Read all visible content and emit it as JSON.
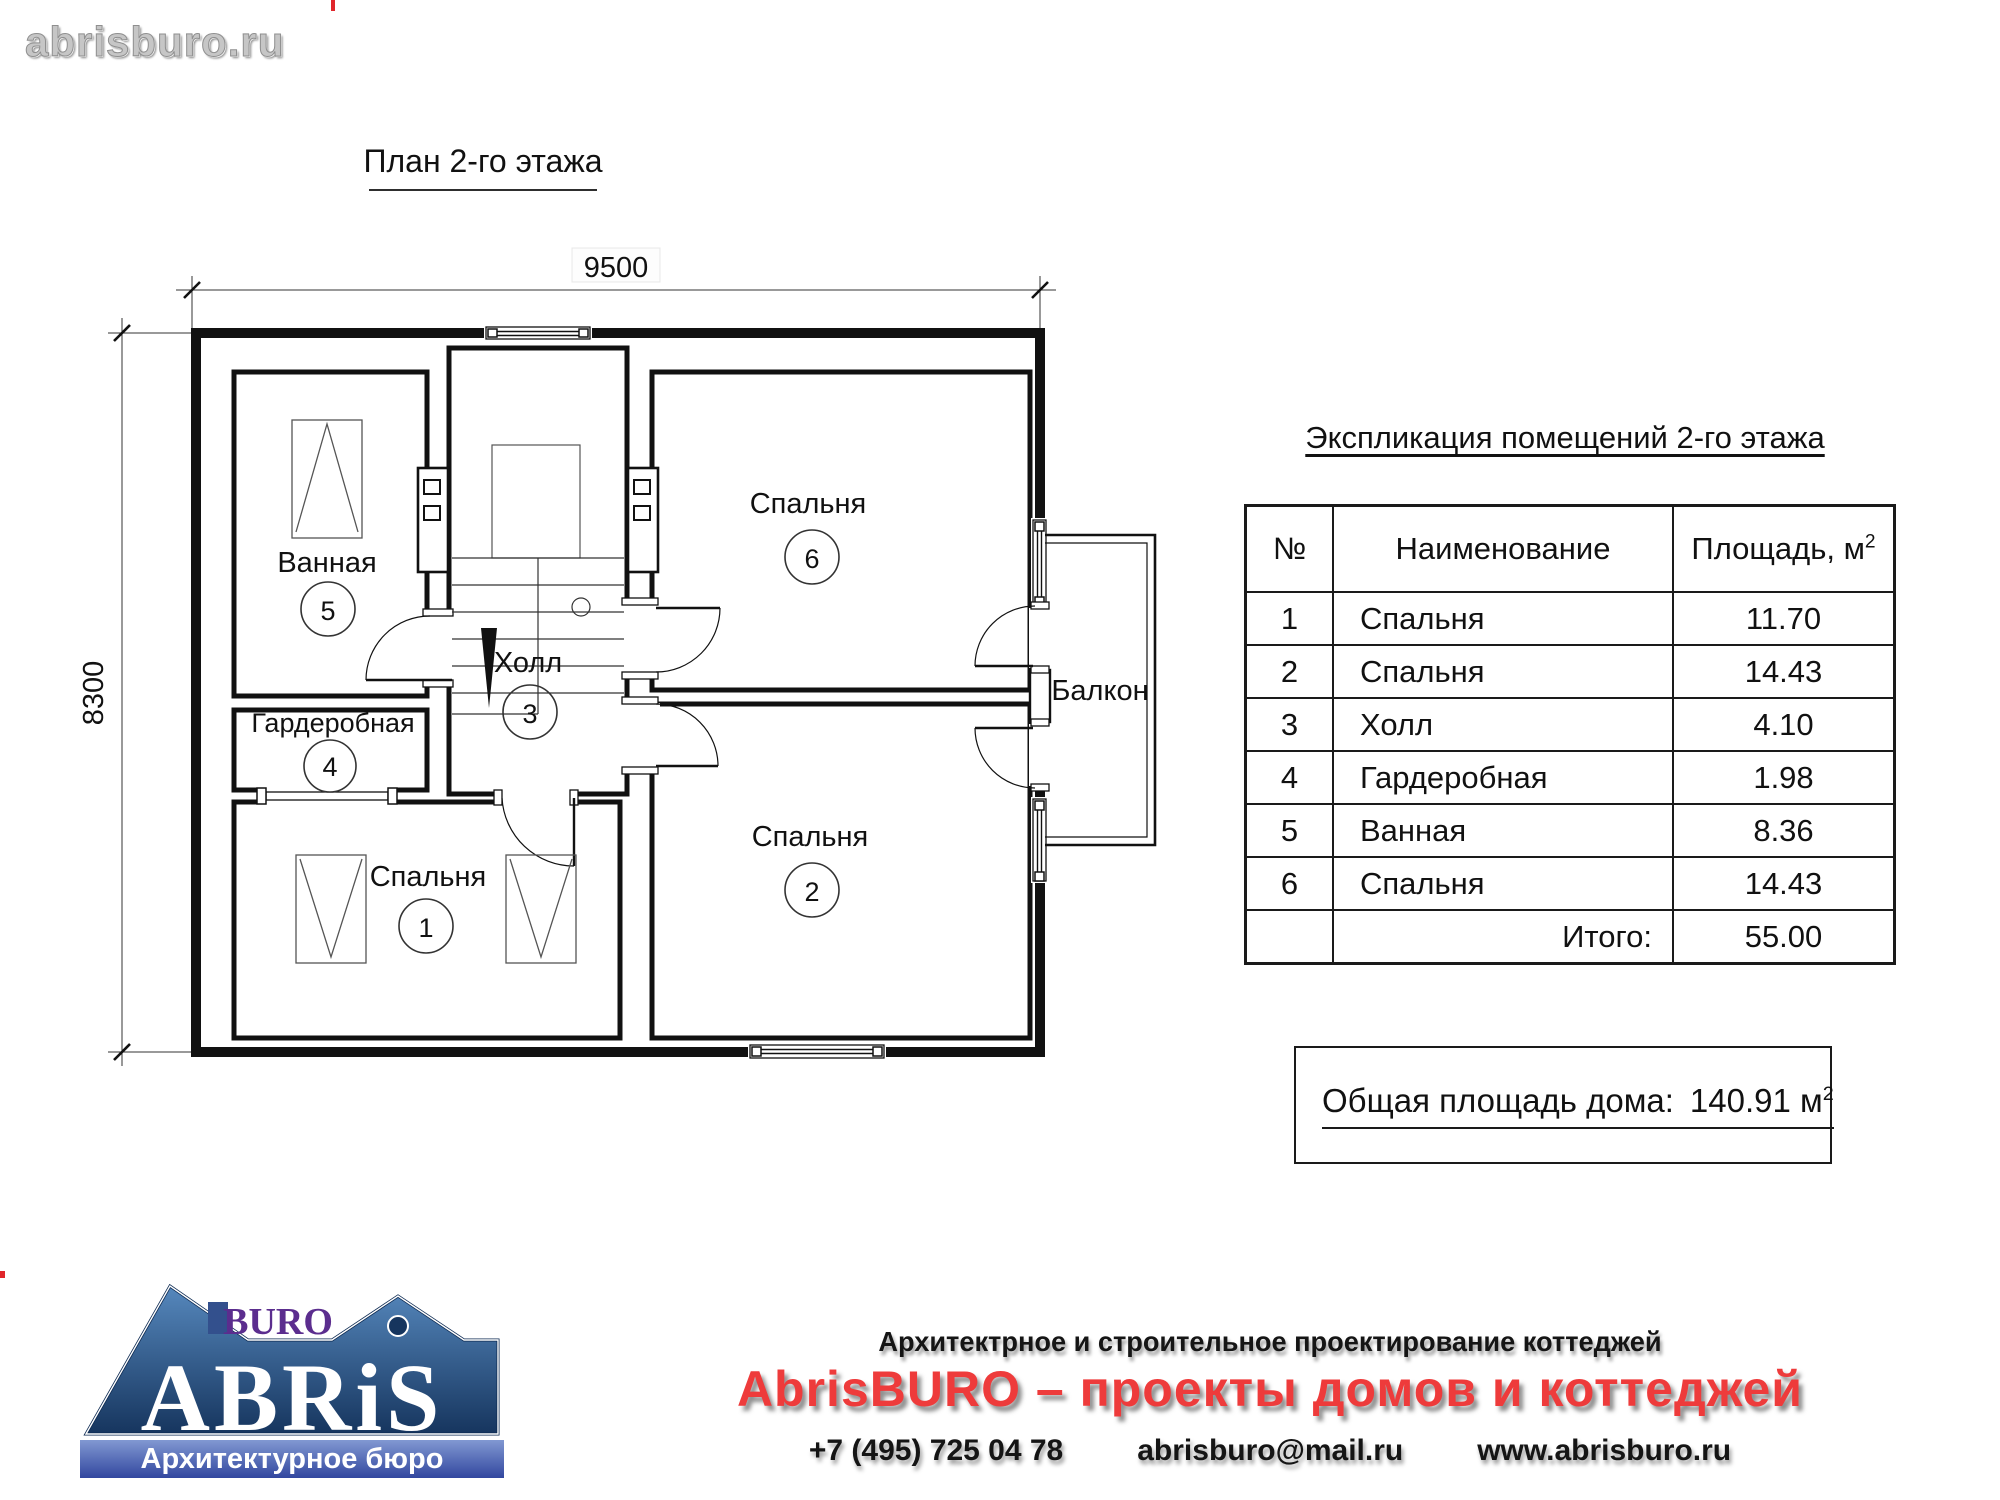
{
  "watermark": "abrisburo.ru",
  "plan": {
    "title": "План 2-го этажа",
    "dim_width": "9500",
    "dim_height": "8300",
    "rooms": [
      {
        "num": "1",
        "label": "Спальня"
      },
      {
        "num": "2",
        "label": "Спальня"
      },
      {
        "num": "3",
        "label": "Холл"
      },
      {
        "num": "4",
        "label": "Гардеробная"
      },
      {
        "num": "5",
        "label": "Ванная"
      },
      {
        "num": "6",
        "label": "Спальня"
      }
    ],
    "balcony_label": "Балкон"
  },
  "legend": {
    "title": "Экспликация помещений 2-го этажа",
    "columns": {
      "num": "№",
      "name": "Наименование",
      "area": "Площадь, м",
      "area_sup": "2"
    },
    "rows": [
      {
        "num": "1",
        "name": "Спальня",
        "area": "11.70"
      },
      {
        "num": "2",
        "name": "Спальня",
        "area": "14.43"
      },
      {
        "num": "3",
        "name": "Холл",
        "area": "4.10"
      },
      {
        "num": "4",
        "name": "Гардеробная",
        "area": "1.98"
      },
      {
        "num": "5",
        "name": "Ванная",
        "area": "8.36"
      },
      {
        "num": "6",
        "name": "Спальня",
        "area": "14.43"
      }
    ],
    "total_label": "Итого:",
    "total_value": "55.00"
  },
  "summary": {
    "label": "Общая площадь дома:",
    "value": "140.91",
    "unit": "м",
    "unit_sup": "2"
  },
  "footer": {
    "logo": {
      "abris": "ABRiS",
      "buro": "BURO",
      "band": "Архитектурное бюро"
    },
    "tagline": "Архитектрное и строительное проектирование коттеджей",
    "headline": "AbrisBURO – проекты домов и коттеджей",
    "phone": "+7 (495) 725 04 78",
    "email": "abrisburo@mail.ru",
    "site": "www.abrisburo.ru"
  },
  "colors": {
    "accent_red": "#ee3b3b",
    "logo_blue": "#4a80b5",
    "logo_blue_dark": "#16355e",
    "logo_purple": "#5b2d8e"
  }
}
